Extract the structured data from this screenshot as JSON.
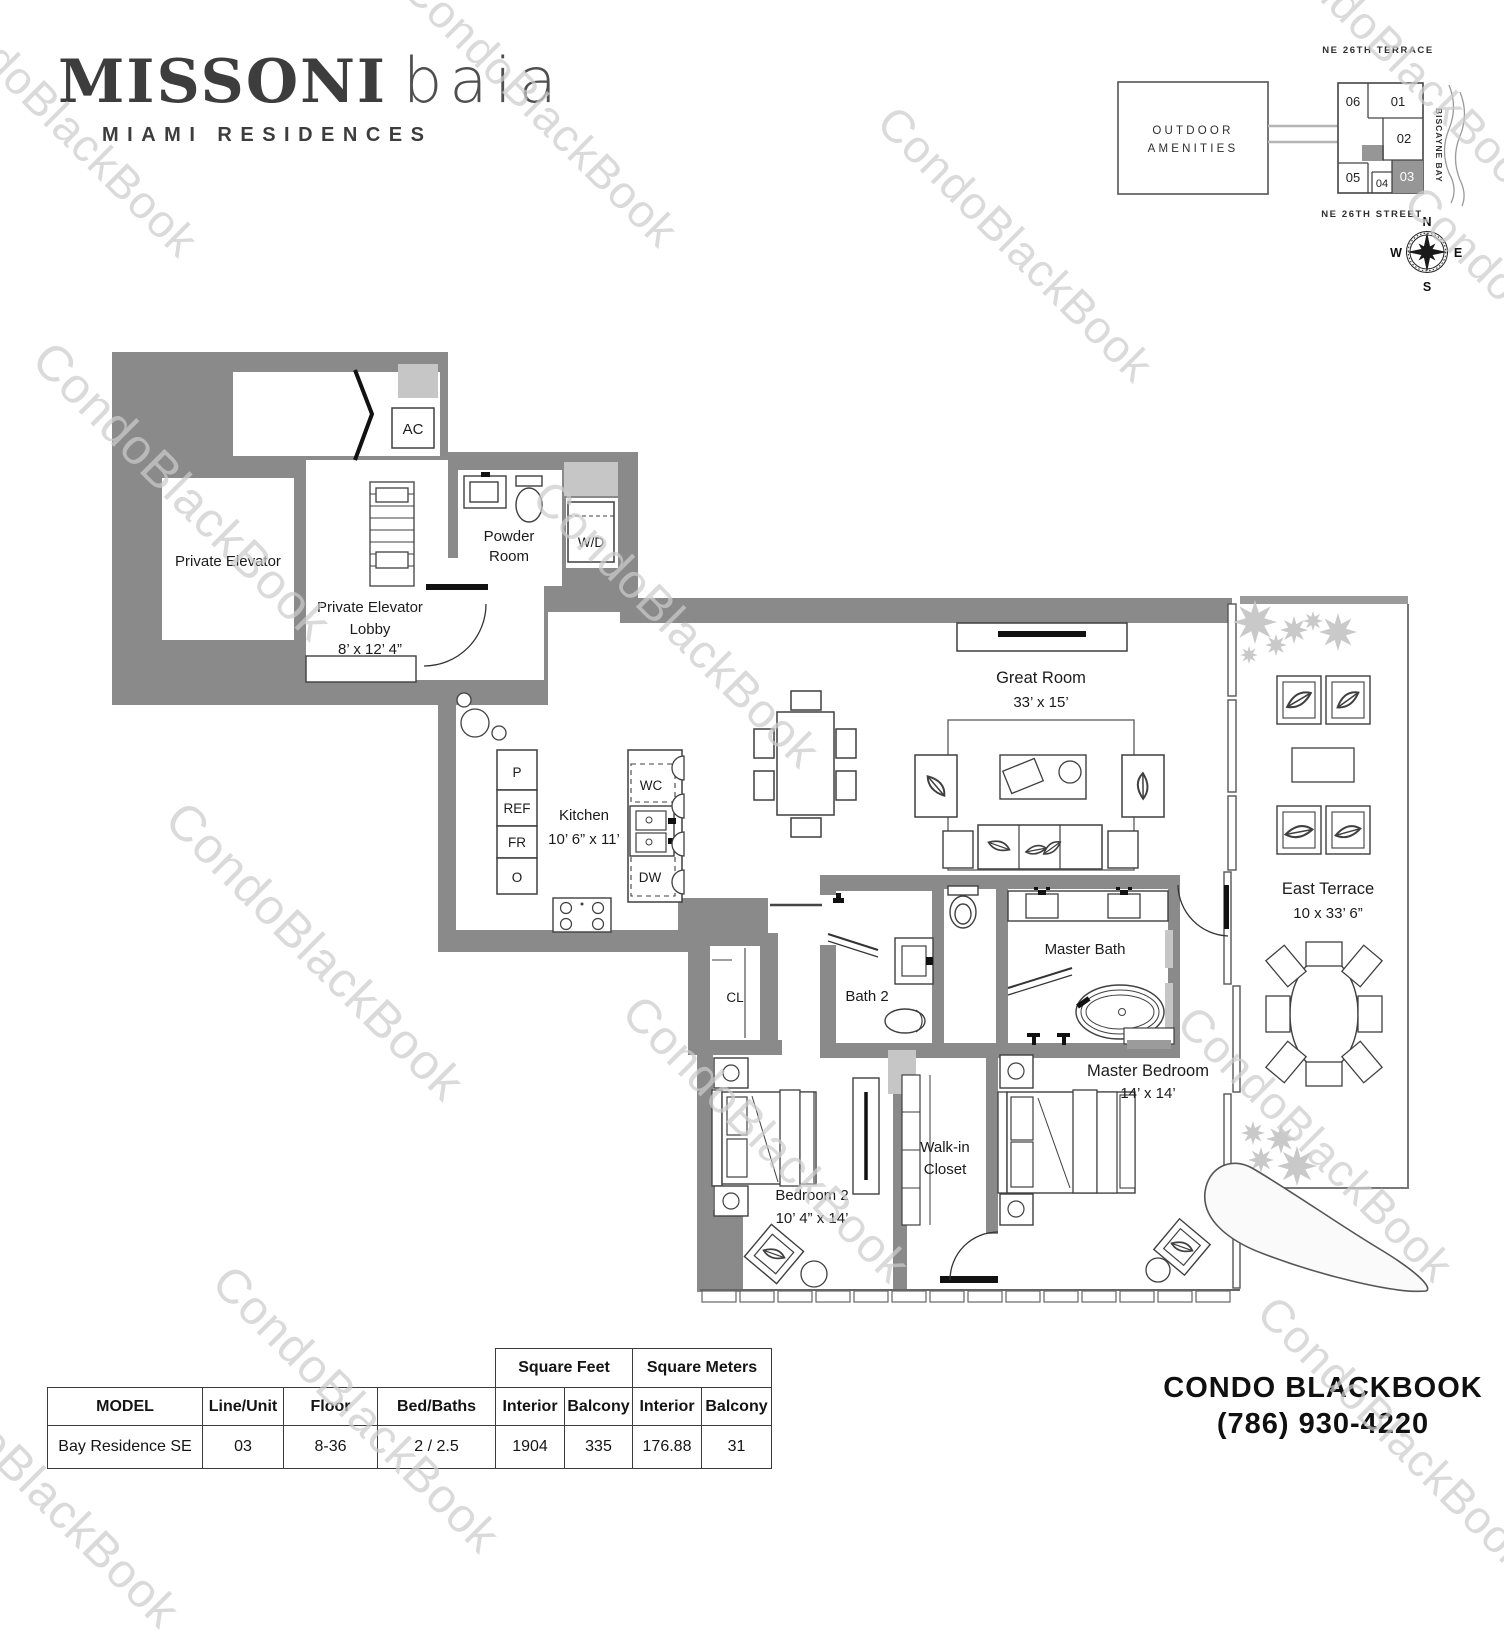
{
  "watermark": {
    "text": "CondoBlackBook"
  },
  "logo": {
    "brand_primary": "MISSONI",
    "brand_secondary": "baia",
    "subtitle": "MIAMI RESIDENCES"
  },
  "site_key": {
    "street_top": "NE 26TH TERRACE",
    "street_bottom": "NE 26TH STREET",
    "bay": "BISCAYNE BAY",
    "amenities_line1": "OUTDOOR",
    "amenities_line2": "AMENITIES",
    "highlighted_unit": "03",
    "units": [
      {
        "label": "06"
      },
      {
        "label": "01"
      },
      {
        "label": "02"
      },
      {
        "label": "03",
        "highlighted": true
      },
      {
        "label": "04"
      },
      {
        "label": "05"
      }
    ],
    "compass": {
      "n": "N",
      "e": "E",
      "s": "S",
      "w": "W"
    },
    "colors": {
      "highlight": "#969696",
      "outline": "#444444"
    }
  },
  "floorplan": {
    "colors": {
      "wall": "#8a8a8a",
      "shaft": "#c6c6c6",
      "fixture": "#3f3f3f",
      "plant": "#c9c9c9"
    },
    "private_elevator": {
      "label": "Private Elevator"
    },
    "lobby": {
      "line1": "Private Elevator",
      "line2": "Lobby",
      "dims": "8’ x 12’ 4”"
    },
    "powder_room": {
      "line1": "Powder",
      "line2": "Room"
    },
    "wd": {
      "label": "W/D"
    },
    "ac": {
      "label": "AC"
    },
    "kitchen": {
      "label": "Kitchen",
      "dims": "10’ 6” x 11’",
      "pantry": "P",
      "fridge": "REF",
      "freezer": "FR",
      "oven": "O",
      "wine_cooler": "WC",
      "dishwasher": "DW"
    },
    "great_room": {
      "label": "Great Room",
      "dims": "33’ x 15’"
    },
    "bath2": {
      "label": "Bath 2"
    },
    "master_bath": {
      "label": "Master Bath"
    },
    "closet": {
      "label": "CL"
    },
    "bedroom2": {
      "label": "Bedroom 2",
      "dims": "10’ 4” x 14’"
    },
    "walk_in_closet": {
      "line1": "Walk-in",
      "line2": "Closet"
    },
    "master_bedroom": {
      "label": "Master Bedroom",
      "dims": "14’ x 14’"
    },
    "east_terrace": {
      "label": "East Terrace",
      "dims": "10 x 33’ 6”"
    }
  },
  "table": {
    "headers": {
      "model": "MODEL",
      "line_unit": "Line/Unit",
      "floor": "Floor",
      "bed_baths": "Bed/Baths",
      "square_feet": "Square Feet",
      "square_meters": "Square Meters",
      "interior": "Interior",
      "balcony": "Balcony"
    },
    "row": {
      "model": "Bay Residence SE",
      "line_unit": "03",
      "floor": "8-36",
      "bed_baths": "2 / 2.5",
      "sqft_interior": "1904",
      "sqft_balcony": "335",
      "sqm_interior": "176.88",
      "sqm_balcony": "31"
    }
  },
  "footer": {
    "brand": "CONDO BLACKBOOK",
    "phone": "(786) 930-4220"
  }
}
